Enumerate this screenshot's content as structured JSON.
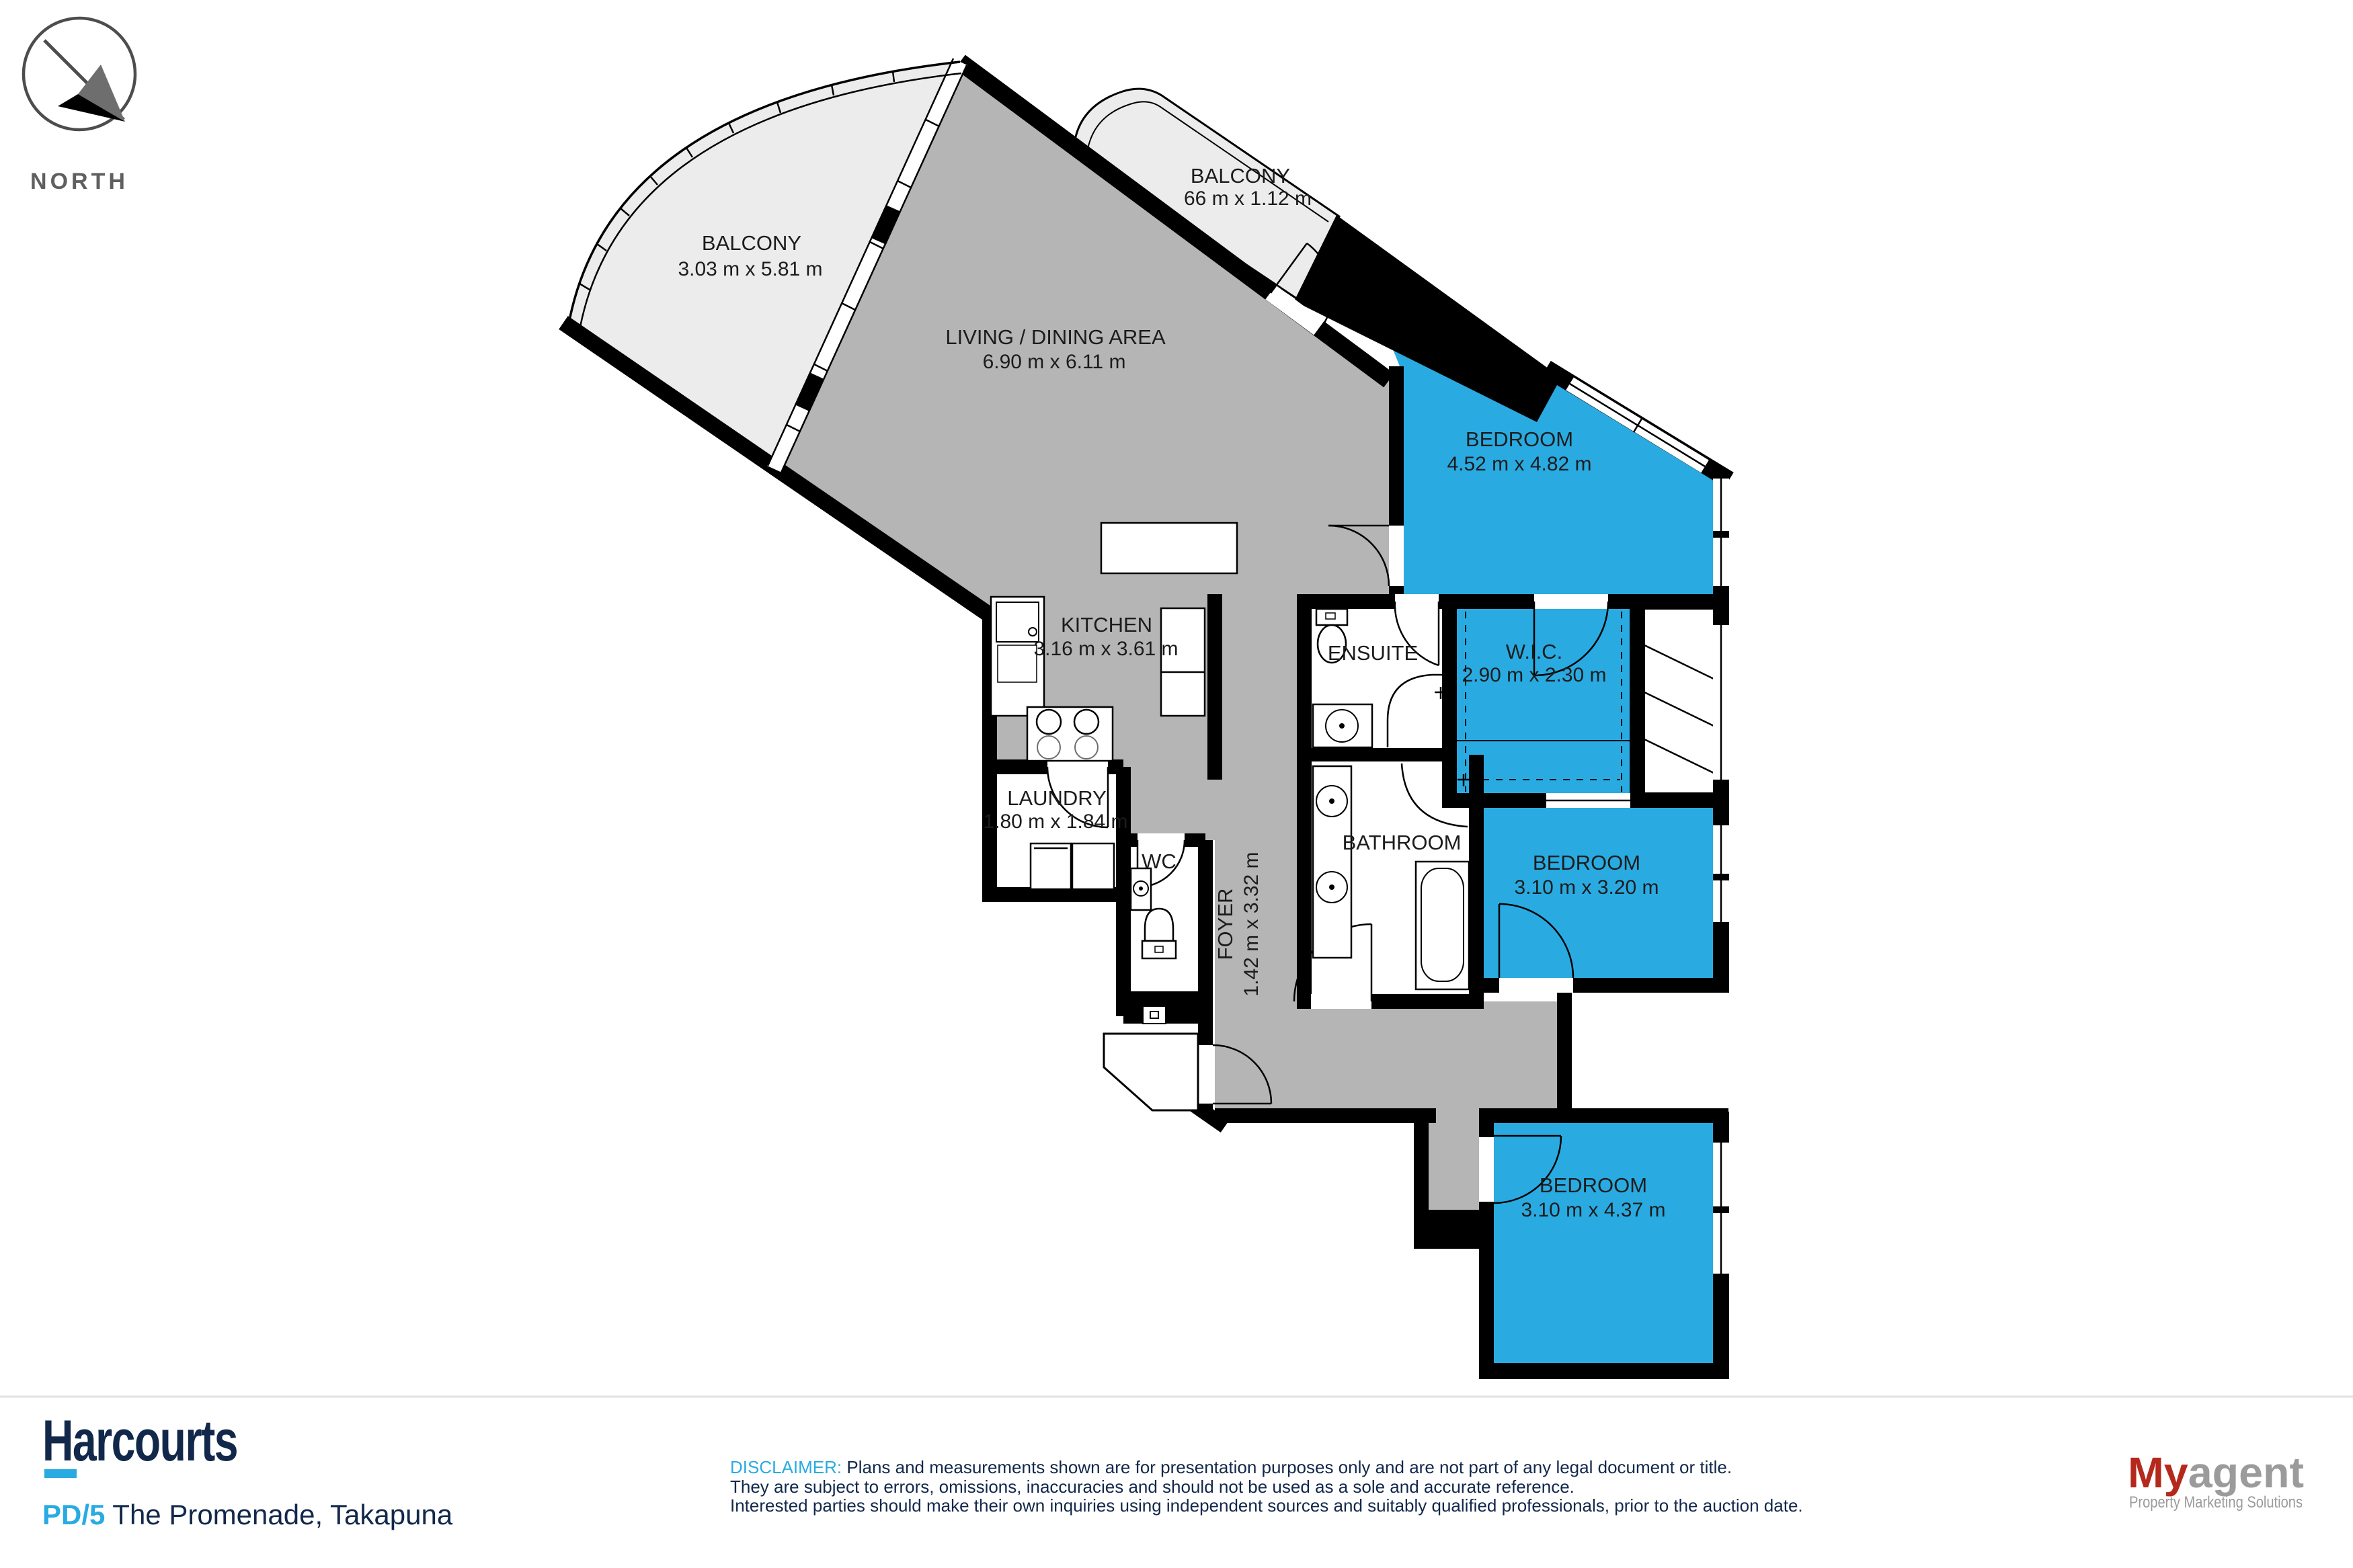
{
  "north": {
    "label": "NORTH"
  },
  "rooms": {
    "balcony_main": {
      "name": "BALCONY",
      "dims": "3.03 m x 5.81 m"
    },
    "balcony_small": {
      "name": "BALCONY",
      "dims": "66 m x 1.12 m"
    },
    "living": {
      "name": "LIVING / DINING AREA",
      "dims": "6.90 m x 6.11 m"
    },
    "bedroom_master": {
      "name": "BEDROOM",
      "dims": "4.52 m x 4.82 m"
    },
    "kitchen": {
      "name": "KITCHEN",
      "dims": "3.16 m x 3.61 m"
    },
    "ensuite": {
      "name": "ENSUITE"
    },
    "wic": {
      "name": "W.I.C.",
      "dims": "2.90 m x 2.30 m"
    },
    "laundry": {
      "name": "LAUNDRY",
      "dims": "1.80 m x 1.84 m"
    },
    "wc": {
      "name": "WC"
    },
    "bathroom": {
      "name": "BATHROOM"
    },
    "foyer": {
      "name": "FOYER",
      "dims": "1.42 m x 3.32 m"
    },
    "bedroom_2": {
      "name": "BEDROOM",
      "dims": "3.10 m x 3.20 m"
    },
    "bedroom_3": {
      "name": "BEDROOM",
      "dims": "3.10 m x 4.37 m"
    }
  },
  "footer": {
    "brand": "Harcourts",
    "listing_ref": "PD/5",
    "address": " The Promenade, Takapuna",
    "disclaimer_label": "DISCLAIMER:",
    "disclaimer_line1": " Plans and measurements shown are for presentation purposes only and are not part of any legal document or title.",
    "disclaimer_line2": "They are subject to errors, omissions, inaccuracies and should not be used as a sole and accurate reference.",
    "disclaimer_line3": "Interested parties should make their own inquiries using independent sources and suitably qualified professionals, prior to the auction date.",
    "agency_brand_primary": "My",
    "agency_brand_secondary": "agent",
    "agency_tagline": "Property Marketing Solutions"
  },
  "colors": {
    "accent_blue": "#29abe2",
    "navy": "#12284b",
    "agency_red": "#b5291c",
    "room_gray": "#b5b5b5",
    "balcony_gray": "#ececec",
    "bedroom_blue": "#29abe2"
  }
}
